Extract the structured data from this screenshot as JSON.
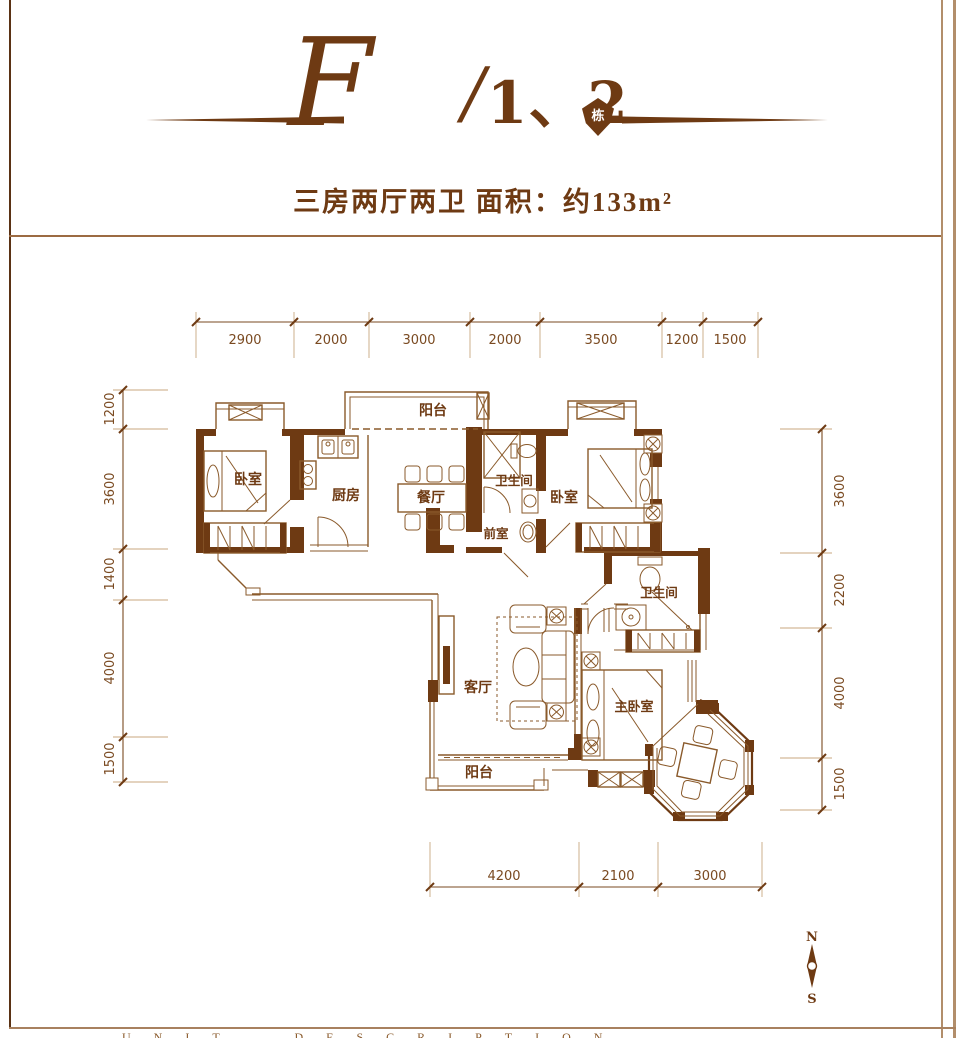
{
  "header": {
    "title_letter": "F",
    "title_slash": "/",
    "title_number": "1、2",
    "title_badge": "栋",
    "subtitle": "三房两厅两卫  面积：约133m²"
  },
  "floorplan": {
    "rooms": [
      {
        "name": "balcony-top",
        "label": "阳台"
      },
      {
        "name": "bedroom-1",
        "label": "卧室"
      },
      {
        "name": "kitchen",
        "label": "厨房"
      },
      {
        "name": "dining-room",
        "label": "餐厅"
      },
      {
        "name": "bathroom-1",
        "label": "卫生间"
      },
      {
        "name": "foyer",
        "label": "前室"
      },
      {
        "name": "bedroom-2",
        "label": "卧室"
      },
      {
        "name": "bathroom-2",
        "label": "卫生间"
      },
      {
        "name": "living-room",
        "label": "客厅"
      },
      {
        "name": "master-bedroom",
        "label": "主卧室"
      },
      {
        "name": "balcony-bottom",
        "label": "阳台"
      }
    ],
    "dimensions": {
      "top": [
        "2900",
        "2000",
        "3000",
        "2000",
        "3500",
        "1200",
        "1500"
      ],
      "left": [
        "1200",
        "3600",
        "1400",
        "4000",
        "1500"
      ],
      "right": [
        "3600",
        "2200",
        "4000",
        "1500"
      ],
      "bottom": [
        "4200",
        "2100",
        "3000"
      ]
    }
  },
  "compass": {
    "north": "N",
    "south": "S"
  },
  "footer": {
    "text": "UNIT DESCRIPTION"
  },
  "colors": {
    "wall": "#6e3a13",
    "line_mid": "#8a5a2b",
    "dim_text": "#7a4a21",
    "frame": "#b28e6b"
  }
}
